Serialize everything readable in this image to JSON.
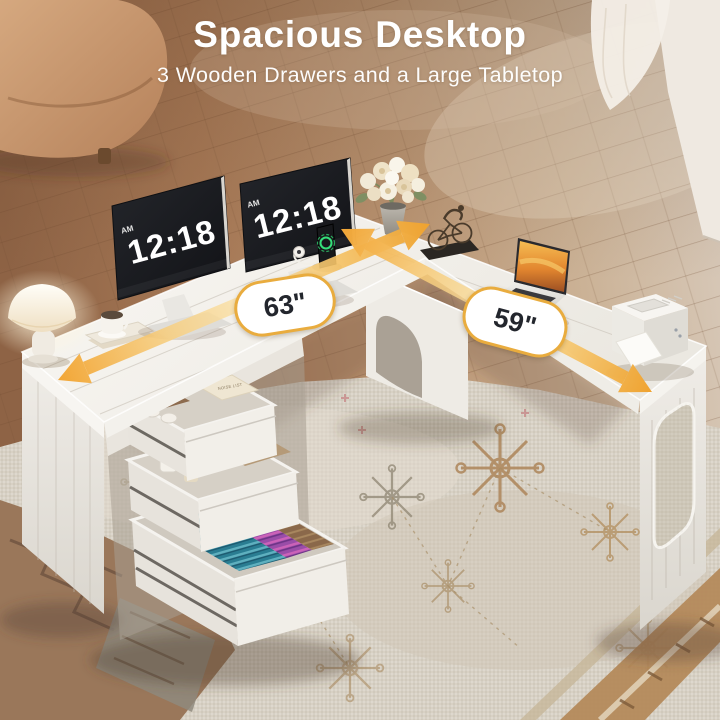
{
  "header": {
    "title": "Spacious Desktop",
    "subtitle": "3 Wooden Drawers and a Large Tabletop"
  },
  "dimensions": {
    "left": {
      "label": "63\""
    },
    "right": {
      "label": "59\""
    }
  },
  "monitors": {
    "left": {
      "time": "12:18",
      "meridiem": "AM"
    },
    "right": {
      "time": "12:18",
      "meridiem": "AM"
    }
  },
  "props": {
    "drawer_book_label": "NOISE LIST"
  },
  "colors": {
    "headline_text": "#FFFFFF",
    "dimension_arrow": "#F2A636",
    "badge_border": "#E9AC3E",
    "badge_background": "#FFFFFF",
    "badge_text": "#23262D",
    "desk_surface": "#F4F2ED",
    "floor_wood": "#B08A64",
    "rug_base": "#D8D1C4"
  },
  "scene_items": [
    "sofa",
    "wood-floor",
    "curtain",
    "area-rug",
    "l-shaped-desk",
    "table-lamp",
    "coffee-cup",
    "book-stack",
    "dual-monitors",
    "phone-charging-dock",
    "smartwatch-charger",
    "flower-vase",
    "bicycle-sculpture",
    "laptop",
    "printer",
    "three-open-drawers",
    "colorful-file-folders"
  ]
}
